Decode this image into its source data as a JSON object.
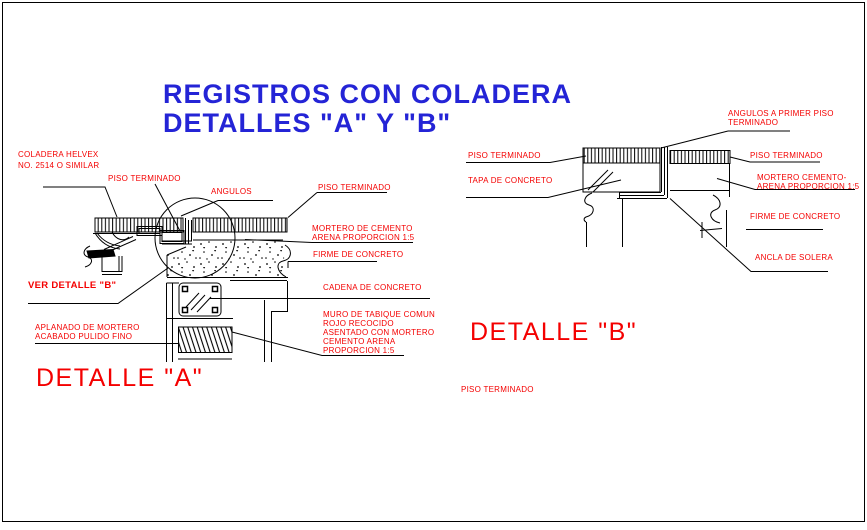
{
  "colors": {
    "label_red": "#f40000",
    "title_blue": "#2424d6",
    "line_black": "#000000",
    "background": "#ffffff"
  },
  "title": {
    "line1": "REGISTROS CON COLADERA",
    "line2": "DETALLES \"A\" Y \"B\""
  },
  "detail_a": {
    "title": "DETALLE \"A\"",
    "labels": {
      "coladera": {
        "l1": "COLADERA HELVEX",
        "l2": "NO. 2514 O SIMILAR"
      },
      "piso_terminado_left": "PISO TERMINADO",
      "angulos": "ANGULOS",
      "piso_terminado_right": "PISO TERMINADO",
      "mortero": {
        "l1": "MORTERO DE CEMENTO",
        "l2": "ARENA PROPORCION 1:5"
      },
      "firme": "FIRME DE CONCRETO",
      "cadena": "CADENA DE CONCRETO",
      "muro": {
        "l1": "MURO DE TABIQUE COMUN",
        "l2": "ROJO RECOCIDO",
        "l3": "ASENTADO CON MORTERO",
        "l4": "CEMENTO ARENA",
        "l5": "PROPORCION 1:5"
      },
      "ver_detalle": "VER DETALLE \"B\"",
      "aplanado": {
        "l1": "APLANADO DE MORTERO",
        "l2": "ACABADO PULIDO FINO"
      }
    }
  },
  "detail_b": {
    "title": "DETALLE \"B\"",
    "labels": {
      "angulos_primer": {
        "l1": "ANGULOS A PRIMER PISO",
        "l2": "TERMINADO"
      },
      "piso_terminado_left": "PISO TERMINADO",
      "tapa": "TAPA DE CONCRETO",
      "piso_terminado_right": "PISO TERMINADO",
      "mortero": {
        "l1": "MORTERO CEMENTO-",
        "l2": "ARENA PROPORCION 1:5"
      },
      "firme": "FIRME DE CONCRETO",
      "ancla": "ANCLA DE SOLERA",
      "piso_note": "PISO TERMINADO"
    }
  }
}
